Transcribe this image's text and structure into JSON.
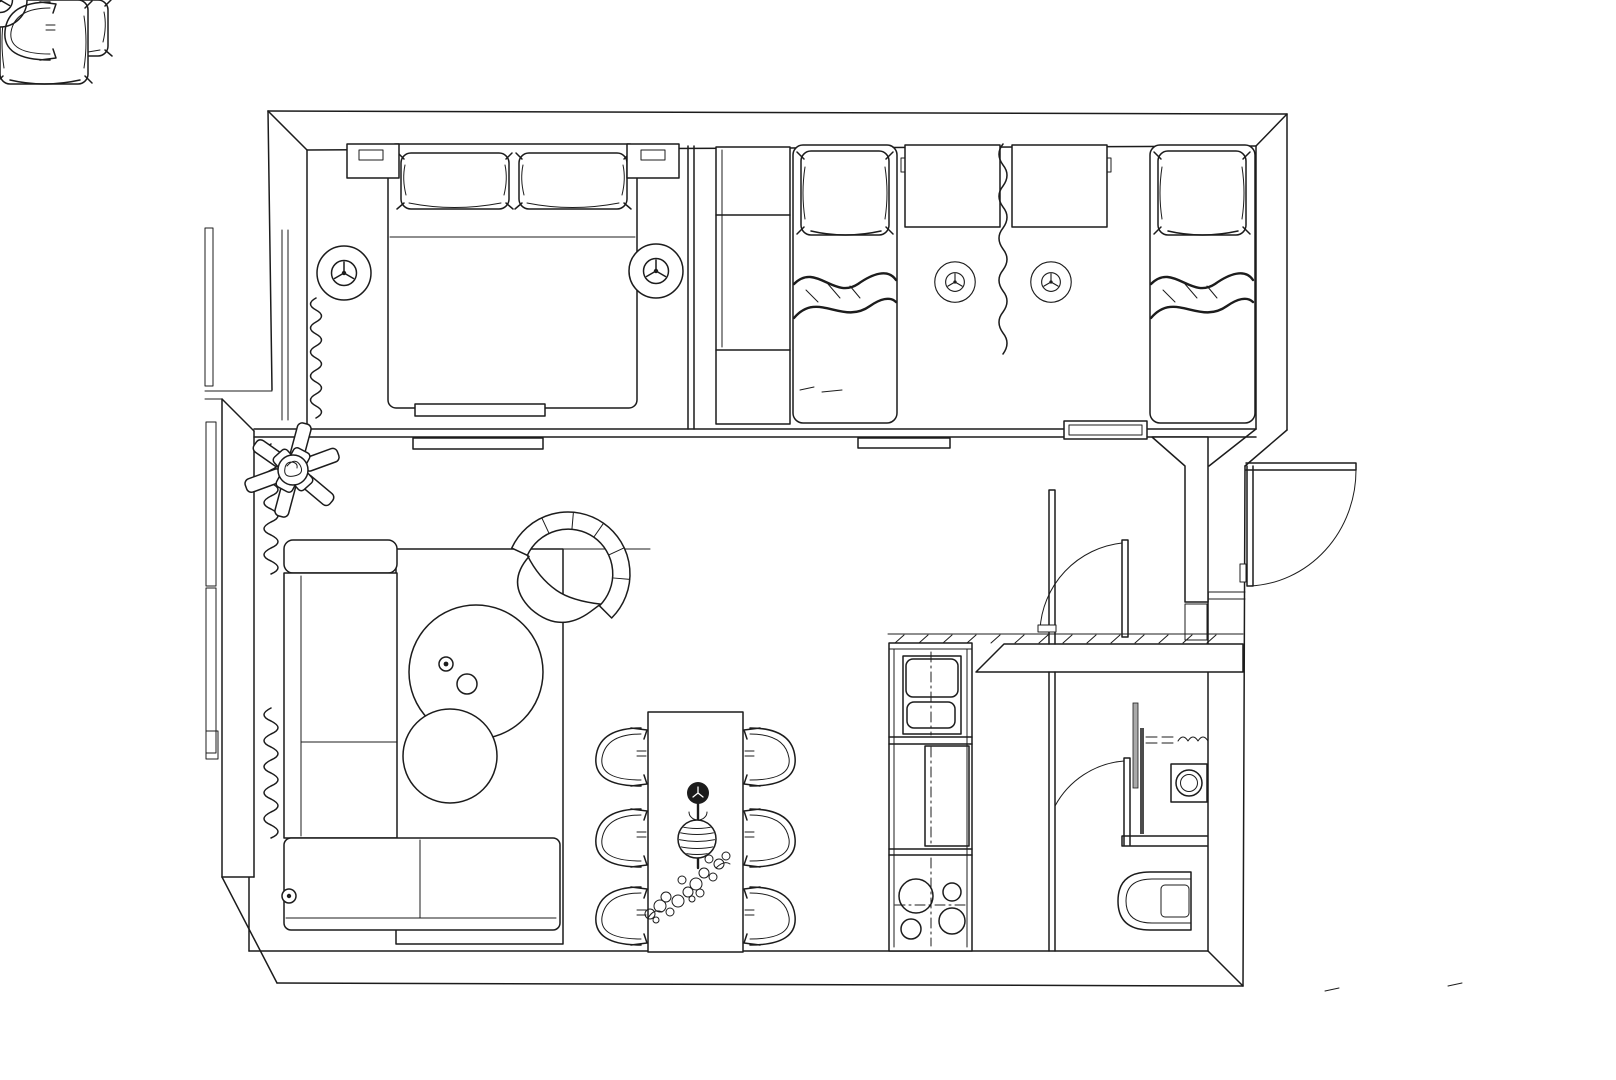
{
  "drawing": {
    "kind": "apartment floor plan, top-down monochrome sketch",
    "units": "px",
    "canvas": {
      "width": 1616,
      "height": 1080
    }
  },
  "colors": {
    "paper": "#ffffff",
    "ink": "#1c1c1c",
    "glass": "#a9a9a9"
  },
  "rooms": [
    {
      "name": "master-bedroom",
      "bbox": [
        307,
        142,
        381,
        295
      ]
    },
    {
      "name": "kids-bedroom",
      "bbox": [
        694,
        142,
        562,
        295
      ]
    },
    {
      "name": "living-dining-area",
      "bbox": [
        254,
        437,
        795,
        514
      ]
    },
    {
      "name": "kitchen-strip",
      "bbox": [
        889,
        643,
        83,
        308
      ]
    },
    {
      "name": "hallway-entry",
      "bbox": [
        1055,
        437,
        154,
        235
      ]
    },
    {
      "name": "bathroom",
      "bbox": [
        1055,
        672,
        152,
        279
      ]
    }
  ],
  "furniture": [
    {
      "name": "double-bed",
      "bbox": [
        388,
        144,
        249,
        264
      ],
      "pillows": 2
    },
    {
      "name": "nightstand",
      "bbox": [
        347,
        144,
        52,
        34
      ]
    },
    {
      "name": "nightstand",
      "bbox": [
        627,
        144,
        52,
        34
      ]
    },
    {
      "name": "wardrobe",
      "bbox": [
        716,
        147,
        74,
        277
      ]
    },
    {
      "name": "single-bed",
      "bbox": [
        793,
        145,
        104,
        278
      ]
    },
    {
      "name": "single-bed",
      "bbox": [
        1150,
        145,
        106,
        278
      ]
    },
    {
      "name": "kids-desk",
      "bbox": [
        905,
        145,
        95,
        82
      ]
    },
    {
      "name": "kids-desk",
      "bbox": [
        1012,
        145,
        95,
        82
      ]
    },
    {
      "name": "ceiling-light",
      "center": [
        344,
        273
      ]
    },
    {
      "name": "ceiling-light",
      "center": [
        656,
        271
      ]
    },
    {
      "name": "ceiling-light",
      "center": [
        955,
        282
      ]
    },
    {
      "name": "ceiling-light",
      "center": [
        1051,
        282
      ]
    },
    {
      "name": "l-shaped-sofa",
      "bbox": [
        284,
        540,
        276,
        390
      ]
    },
    {
      "name": "rug",
      "bbox": [
        396,
        549,
        167,
        395
      ]
    },
    {
      "name": "coffee-table-large",
      "center": [
        476,
        672
      ],
      "radius": 67
    },
    {
      "name": "coffee-table-small",
      "center": [
        450,
        756
      ],
      "radius": 47
    },
    {
      "name": "armchair",
      "bbox": [
        505,
        512,
        125,
        124
      ]
    },
    {
      "name": "floor-plant",
      "center": [
        293,
        470
      ]
    },
    {
      "name": "dining-table",
      "bbox": [
        648,
        712,
        95,
        240
      ]
    },
    {
      "name": "dining-chair-count",
      "value": 6
    },
    {
      "name": "pendant-lamp",
      "center": [
        698,
        816
      ]
    },
    {
      "name": "kitchen-sink",
      "bbox": [
        903,
        656,
        58,
        78
      ]
    },
    {
      "name": "oven-cabinet",
      "bbox": [
        925,
        746,
        44,
        100
      ]
    },
    {
      "name": "cooktop-burners",
      "value": 4
    },
    {
      "name": "washing-machine",
      "bbox": [
        1171,
        764,
        36,
        38
      ]
    },
    {
      "name": "toilet",
      "bbox": [
        1118,
        872,
        73,
        58
      ]
    },
    {
      "name": "shower-glass-panel",
      "bbox": [
        1133,
        703,
        5,
        85
      ]
    }
  ],
  "openings": [
    {
      "name": "entrance-door-swing",
      "hinge": [
        1248,
        469
      ],
      "swing": "outward-right"
    },
    {
      "name": "living-room-door-swing",
      "hinge": [
        1126,
        637
      ]
    },
    {
      "name": "bathroom-door-swing",
      "hinge": [
        1127,
        845
      ]
    },
    {
      "name": "sliding-door-panel",
      "bbox": [
        413,
        438,
        130,
        11
      ]
    },
    {
      "name": "sliding-door-panel",
      "bbox": [
        858,
        438,
        92,
        10
      ]
    },
    {
      "name": "window-curtain-zigzag",
      "count": 4
    },
    {
      "name": "balcony-window",
      "bbox": [
        205,
        422,
        11,
        333
      ]
    }
  ]
}
